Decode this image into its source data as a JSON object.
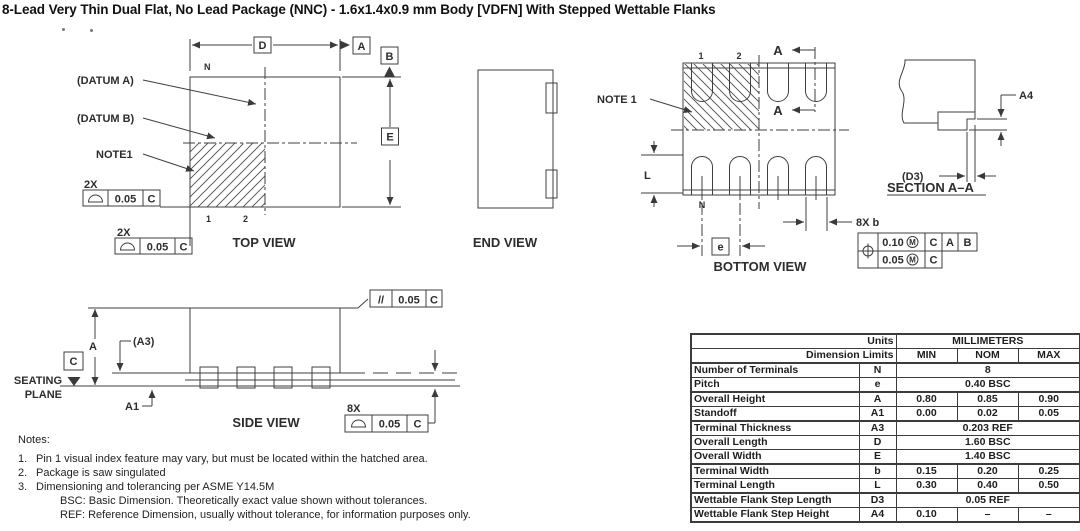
{
  "title": "8-Lead Very Thin Dual Flat, No Lead Package (NNC) - 1.6x1.4x0.9 mm Body [VDFN]  With Stepped Wettable Flanks",
  "top_view": {
    "caption": "TOP VIEW",
    "datum_a_label": "(DATUM A)",
    "datum_b_label": "(DATUM B)",
    "note1_label": "NOTE1",
    "n_label": "N",
    "pin1": "1",
    "pin2": "2",
    "dim_d": "D",
    "datum_a_flag": "A",
    "datum_b_flag": "B",
    "dim_e": "E",
    "qty_top": "2X",
    "qty_bottom": "2X",
    "fcf_top": {
      "tol": "0.05",
      "datum": "C"
    },
    "fcf_bottom": {
      "tol": "0.05",
      "datum": "C"
    }
  },
  "end_view": {
    "caption": "END VIEW"
  },
  "bottom_view": {
    "caption": "BOTTOM VIEW",
    "note1_label": "NOTE 1",
    "pin1": "1",
    "pin2": "2",
    "section_a_top": "A",
    "section_a_bottom": "A",
    "dim_l": "L",
    "n_label": "N",
    "pitch_sym": "e",
    "qty_b": "8X b",
    "fcf": {
      "tol1": "0.10",
      "mod1": "M",
      "d1a": "C",
      "d1b": "A",
      "d1c": "B",
      "tol2": "0.05",
      "mod2": "M",
      "d2a": "C"
    }
  },
  "section_view": {
    "caption": "SECTION A–A",
    "dim_a4": "A4",
    "dim_d3": "(D3)"
  },
  "side_view": {
    "caption": "SIDE VIEW",
    "dim_a": "A",
    "dim_a1": "A1",
    "dim_a3": "(A3)",
    "datum_c": "C",
    "seating1": "SEATING",
    "seating2": "PLANE",
    "par": {
      "sym": "//",
      "tol": "0.05",
      "datum": "C"
    },
    "qty": "8X",
    "prof": {
      "tol": "0.05",
      "datum": "C"
    }
  },
  "notes": {
    "heading": "Notes:",
    "items": [
      {
        "num": "1.",
        "text": "Pin 1 visual index feature may vary, but must be located within the hatched area."
      },
      {
        "num": "2.",
        "text": "Package is saw singulated"
      },
      {
        "num": "3.",
        "text": "Dimensioning and tolerancing per ASME Y14.5M"
      }
    ],
    "subitems": [
      "BSC: Basic Dimension. Theoretically exact value shown without tolerances.",
      "REF: Reference Dimension, usually without tolerance, for information purposes only."
    ]
  },
  "dim_table": {
    "units_label": "Units",
    "units_value": "MILLIMETERS",
    "limits_label": "Dimension Limits",
    "col_min": "MIN",
    "col_nom": "NOM",
    "col_max": "MAX",
    "rows": [
      {
        "name": "Number of Terminals",
        "sym": "N",
        "span": "8"
      },
      {
        "name": "Pitch",
        "sym": "e",
        "span": "0.40 BSC"
      },
      {
        "name": "Overall Height",
        "sym": "A",
        "min": "0.80",
        "nom": "0.85",
        "max": "0.90"
      },
      {
        "name": "Standoff",
        "sym": "A1",
        "min": "0.00",
        "nom": "0.02",
        "max": "0.05"
      },
      {
        "name": "Terminal Thickness",
        "sym": "A3",
        "span": "0.203 REF"
      },
      {
        "name": "Overall Length",
        "sym": "D",
        "span": "1.60 BSC"
      },
      {
        "name": "Overall Width",
        "sym": "E",
        "span": "1.40 BSC"
      },
      {
        "name": "Terminal Width",
        "sym": "b",
        "min": "0.15",
        "nom": "0.20",
        "max": "0.25"
      },
      {
        "name": "Terminal Length",
        "sym": "L",
        "min": "0.30",
        "nom": "0.40",
        "max": "0.50"
      },
      {
        "name": "Wettable Flank Step Length",
        "sym": "D3",
        "span": "0.05 REF"
      },
      {
        "name": "Wettable Flank Step Height",
        "sym": "A4",
        "min": "0.10",
        "nom": "–",
        "max": "–"
      }
    ]
  }
}
